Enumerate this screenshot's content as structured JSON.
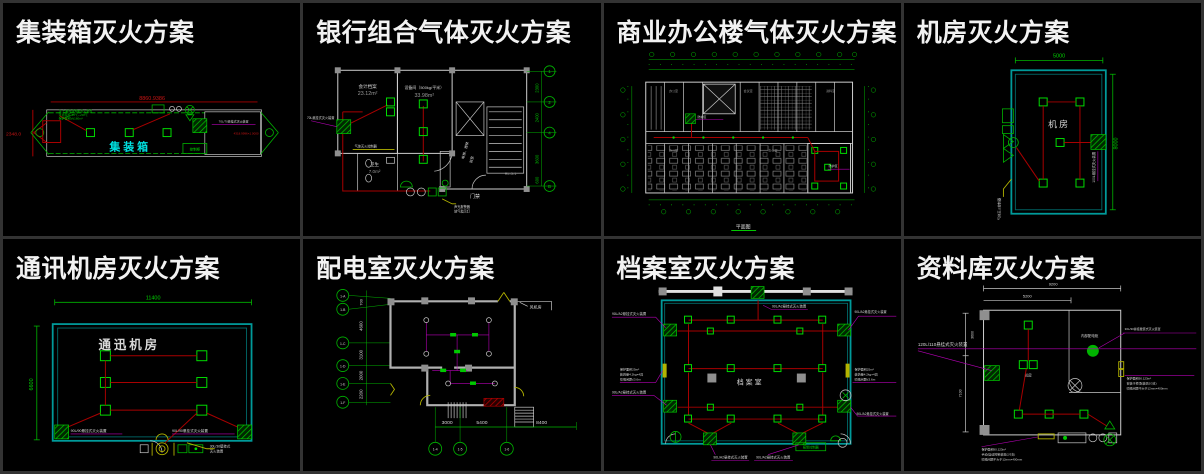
{
  "colors": {
    "background": "#000000",
    "divider": "#333333",
    "title_text": "#f2f2f2",
    "cad_green": "#00c800",
    "cad_red": "#b40000",
    "cad_cyan": "#00b4b4",
    "cad_magenta": "#b400b4",
    "cad_yellow": "#b4b400",
    "cad_white": "#d8d8d8"
  },
  "panels": {
    "p1": {
      "title": "集装箱灭火方案",
      "dim_top": "8860.9386",
      "dim_left": "2348.0",
      "dim_right": "4318.9996×1.0000",
      "room": "集装箱",
      "note_right": "70L/70悬挂式灭火装置",
      "note_left1": "注:七氟丙烷预制灭火装置",
      "note_left2": "环境温度-10℃~+50℃",
      "note_left3": "保护容积V≤160m³",
      "box_label": "控制柜"
    },
    "p2": {
      "title": "银行组合气体灭火方案",
      "room1": "会计档案",
      "area1": "23.12m²",
      "room2": "设备间（500kg/平米）",
      "area2": "33.98m²",
      "room3": "卫生",
      "area3": "7.0m²",
      "door_label": "门禁",
      "stair_label": "RL-5-1",
      "lobby1": "电梯、楼梯",
      "lobby2": "前室",
      "axis": [
        "1",
        "2",
        "4",
        "B"
      ],
      "dims": [
        "2300",
        "2400",
        "3600",
        "600"
      ],
      "note_left": "70L悬挂式灭火装置",
      "note_mid": "气体灭火控制器",
      "note_b1": "声光报警器",
      "note_b2": "放气指示灯"
    },
    "p3": {
      "title": "商业办公楼气体灭火方案",
      "plan_label": "平面图",
      "zone1": "防护区",
      "zone2": "防护区",
      "rooms": [
        "办公室",
        "会议室",
        "资料室",
        "办公室",
        "办公室"
      ]
    },
    "p4": {
      "title": "机房灭火方案",
      "dim_top": "5000",
      "dim_right": "8000",
      "room": "机房",
      "note_right": "100L悬挂式灭火装置",
      "note_left": "气体灭火控制器"
    },
    "p5": {
      "title": "通讯机房灭火方案",
      "dim_top": "11400",
      "dim_left": "6600",
      "room": "通迅机房",
      "note_left": "90L/90悬挂式灭火装置",
      "note_right": "90L/90悬挂式灭火装置",
      "note_y1": "30L/30壁挂式",
      "note_y2": "灭火装置"
    },
    "p6": {
      "title": "配电室灭火方案",
      "fan_room": "风机房",
      "dims_left": [
        "700",
        "4600",
        "3100",
        "2000",
        "2200"
      ],
      "dims_bottom": [
        "3000",
        "5400",
        "8400"
      ],
      "axis_left": [
        "1-A",
        "1-B",
        "1-C",
        "1-D",
        "1-E",
        "1-F"
      ],
      "axis_bottom": [
        "1-4",
        "1-5",
        "1-6"
      ]
    },
    "p7": {
      "title": "档案室灭火方案",
      "room": "档案室",
      "note": "90L/A2悬挂式灭火装置",
      "mid1": "保护面积25m²",
      "mid2": "装药量4.2kg×4具",
      "mid3": "喷嘴间距≤3.6m",
      "panel_box": "报警控制器"
    },
    "p8": {
      "title": "资料库灭火方案",
      "dim_top1": "9200",
      "dim_top2": "5200",
      "dim_left1": "3600",
      "dim_left2": "7100",
      "label_left": "120L/110悬挂式灭火装置",
      "label_right": "30L/30悬挂壁装式灭火装置",
      "cabinet": "内部配电柜",
      "room": "机房",
      "r1": "保护面积90.123m²",
      "r2": "安装于柜顶(装药2/3支)",
      "r3": "喷嘴间距不大于12mm×400mm",
      "b1": "保护面积90.123m²",
      "b2": "手动/自动控制装置(2/3支)",
      "b3": "喷嘴间距不大于12mm×400mm"
    }
  }
}
